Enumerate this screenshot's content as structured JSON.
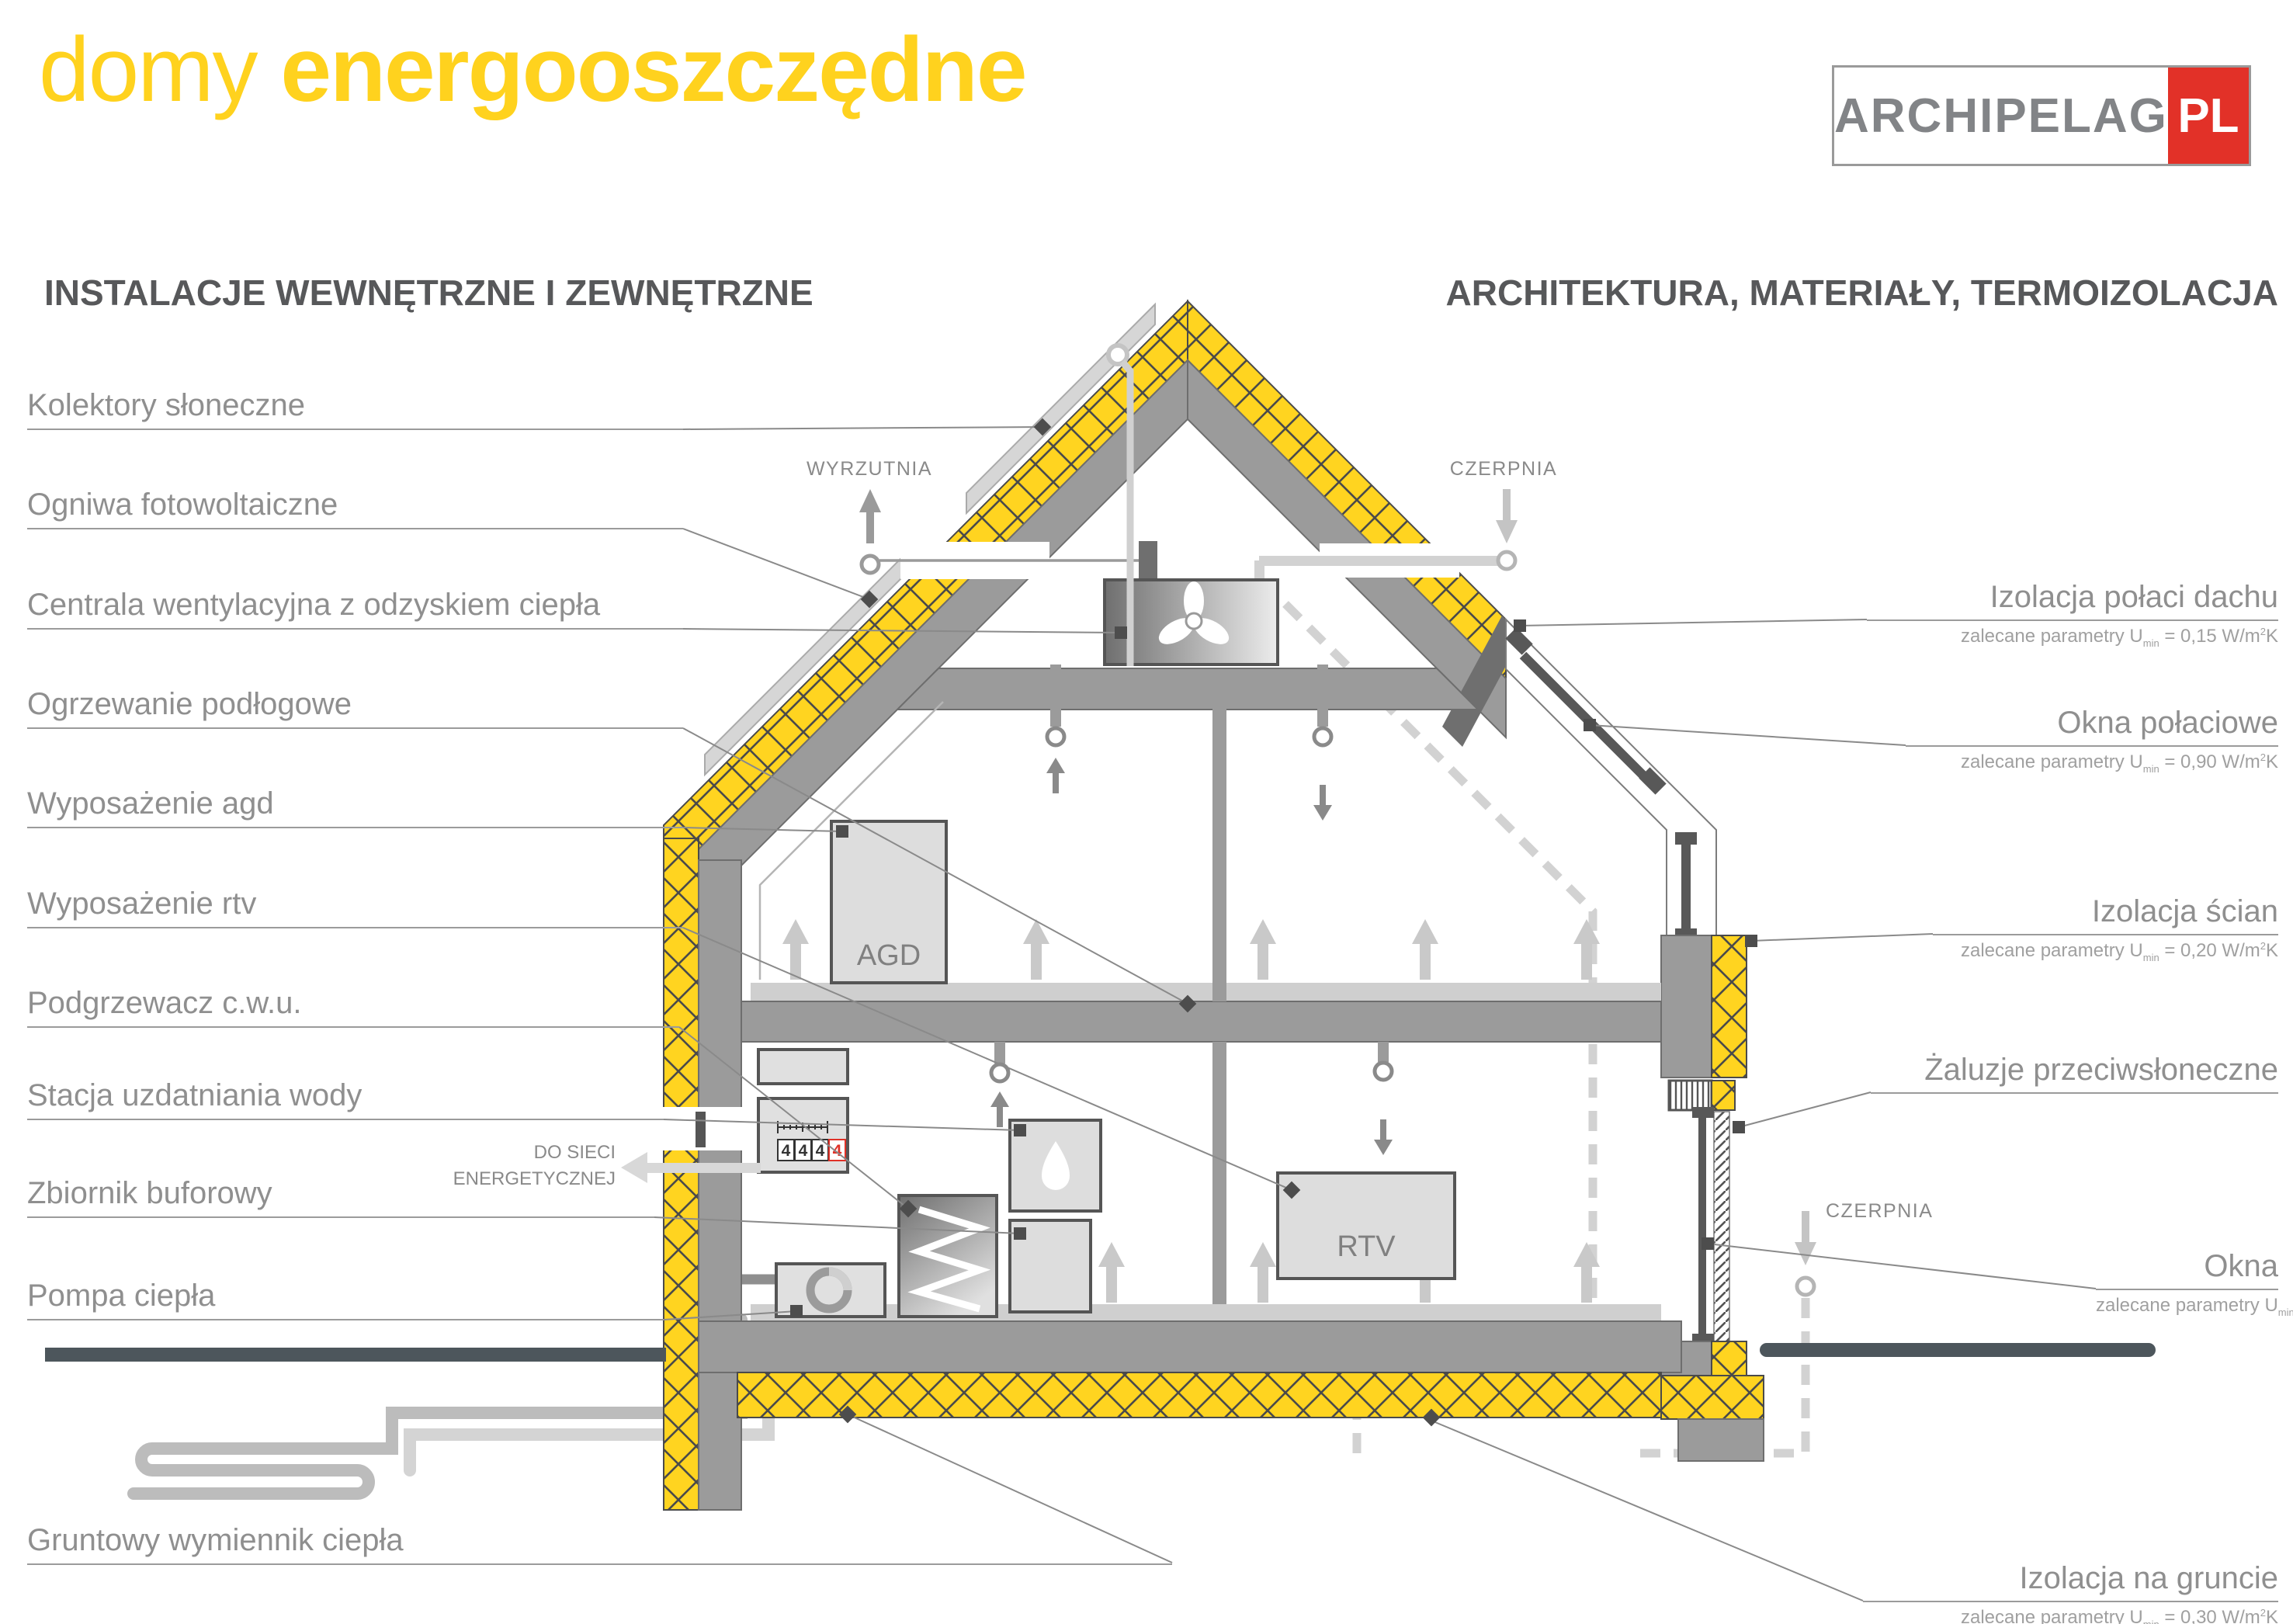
{
  "title": {
    "light": "domy",
    "bold": "energooszczędne"
  },
  "logo": {
    "name": "ARCHIPELAG",
    "tld": "PL"
  },
  "sections": {
    "left": "INSTALACJE WEWNĘTRZNE I ZEWNĘTRZNE",
    "right": "ARCHITEKTURA, MATERIAŁY, TERMOIZOLACJA"
  },
  "left_labels": [
    {
      "text": "Kolektory słoneczne"
    },
    {
      "text": "Ogniwa fotowoltaiczne"
    },
    {
      "text": "Centrala wentylacyjna z odzyskiem ciepła"
    },
    {
      "text": "Ogrzewanie podłogowe"
    },
    {
      "text": "Wyposażenie agd"
    },
    {
      "text": "Wyposażenie rtv"
    },
    {
      "text": "Podgrzewacz c.w.u."
    },
    {
      "text": "Stacja uzdatniania wody"
    },
    {
      "text": "Zbiornik buforowy"
    },
    {
      "text": "Pompa ciepła"
    },
    {
      "text": "Gruntowy wymiennik ciepła"
    }
  ],
  "right_labels": [
    {
      "text": "Izolacja połaci dachu",
      "note_prefix": "zalecane parametry U",
      "note_sub": "min",
      "note_mid": " = 0,15 W/m",
      "note_sup": "2",
      "note_suffix": "K"
    },
    {
      "text": "Okna połaciowe",
      "note_prefix": "zalecane parametry U",
      "note_sub": "min",
      "note_mid": " = 0,90 W/m",
      "note_sup": "2",
      "note_suffix": "K"
    },
    {
      "text": "Izolacja ścian",
      "note_prefix": "zalecane parametry U",
      "note_sub": "min",
      "note_mid": " = 0,20 W/m",
      "note_sup": "2",
      "note_suffix": "K"
    },
    {
      "text": "Żaluzje przeciwsłoneczne",
      "note_prefix": "",
      "note_sub": "",
      "note_mid": "",
      "note_sup": "",
      "note_suffix": ""
    },
    {
      "text": "Okna",
      "note_prefix": "zalecane parametry U",
      "note_sub": "min",
      "note_mid": " = 0,90 W/m",
      "note_sup": "2",
      "note_suffix": "K"
    },
    {
      "text": "Izolacja na gruncie",
      "note_prefix": "zalecane parametry U",
      "note_sub": "min",
      "note_mid": " = 0,30 W/m",
      "note_sup": "2",
      "note_suffix": "K"
    }
  ],
  "diagram": {
    "wyrzutnia": "WYRZUTNIA",
    "czerpnia_roof": "CZERPNIA",
    "czerpnia_wall": "CZERPNIA",
    "grid_line1": "DO SIECI",
    "grid_line2": "ENERGETYCZNEJ",
    "agd": "AGD",
    "rtv": "RTV",
    "meter_digits": [
      "4",
      "4",
      "4",
      "4"
    ]
  },
  "colors": {
    "brand_yellow": "#FFD420",
    "logo_red": "#E23128",
    "structure_gray": "#9b9b9b",
    "dark_outline": "#555555",
    "label_gray": "#8f8f8f",
    "terrain": "#4d565c",
    "meter_alert_red": "#E03127"
  }
}
